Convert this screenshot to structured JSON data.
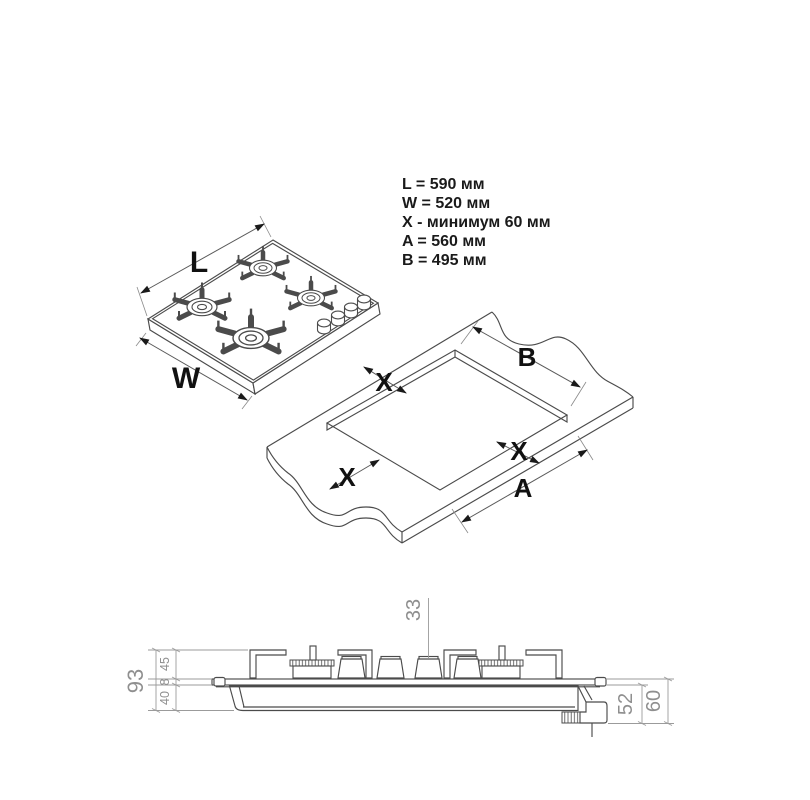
{
  "specs": {
    "lines": [
      "L = 590 мм",
      "W = 520 мм",
      "X - минимум 60 мм",
      "A = 560 мм",
      "B = 495 мм"
    ]
  },
  "hob_view": {
    "length_label": "L",
    "width_label": "W"
  },
  "cutout_view": {
    "b_label": "B",
    "a_label": "A",
    "x_top_label": "X",
    "x_left_label": "X",
    "x_right_label": "X"
  },
  "side_view": {
    "total_height_mm": "93",
    "above_counter_mm": "45",
    "glass_thickness_mm": "8",
    "below_counter_mm": "40",
    "knob_height_mm": "33",
    "gas_connector_mm": "52",
    "gas_connector_total_mm": "60"
  },
  "colors": {
    "background": "#ffffff",
    "drawing_line": "#4b4b4b",
    "dimension_line": "#9b9b9b",
    "dimension_text": "#8f8f8f",
    "label_text": "#111111"
  }
}
